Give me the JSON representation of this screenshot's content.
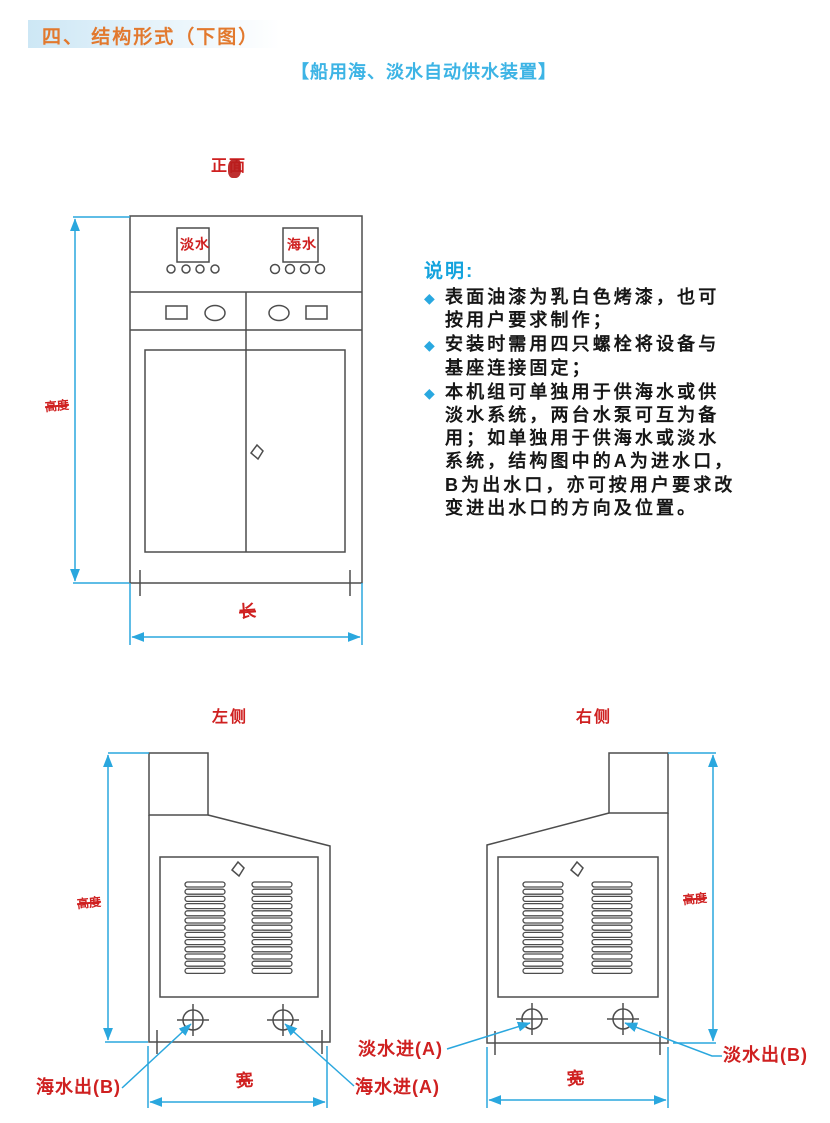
{
  "header": {
    "title": "四、 结构形式（下图）"
  },
  "subtitle": "【船用海、淡水自动供水装置】",
  "notes": {
    "heading": "说明:",
    "bullet_glyph": "◆",
    "items": [
      {
        "text": "表面油漆为乳白色烤漆，也可\n按用户要求制作；"
      },
      {
        "text": "安装时需用四只螺栓将设备与\n基座连接固定；"
      },
      {
        "text": "本机组可单独用于供海水或供\n淡水系统，两台水泵可互为备\n用；如单独用于供海水或淡水\n系统，结构图中的A为进水口，\nB为出水口，亦可按用户要求改\n变进出水口的方向及位置。"
      }
    ]
  },
  "front_view": {
    "title": "正面",
    "display_left": "淡水",
    "display_right": "海水",
    "dim_length": "长",
    "dim_height": "高度"
  },
  "left_view": {
    "title": "左侧",
    "dim_width": "宽",
    "dim_height": "高度",
    "labels": {
      "sea_out": "海水出(B)",
      "sea_in": "海水进(A)",
      "fresh_in": "淡水进(A)"
    }
  },
  "right_view": {
    "title": "右侧",
    "dim_width": "宽",
    "dim_height": "高度",
    "labels": {
      "fresh_out": "淡水出(B)"
    }
  },
  "colors": {
    "header_orange": "#e2792e",
    "title_blue": "#3db4e5",
    "note_blue": "#13a3dd",
    "dimension_blue": "#2aa7de",
    "line_gray": "#4d4d4d",
    "label_red": "#cf2020"
  }
}
